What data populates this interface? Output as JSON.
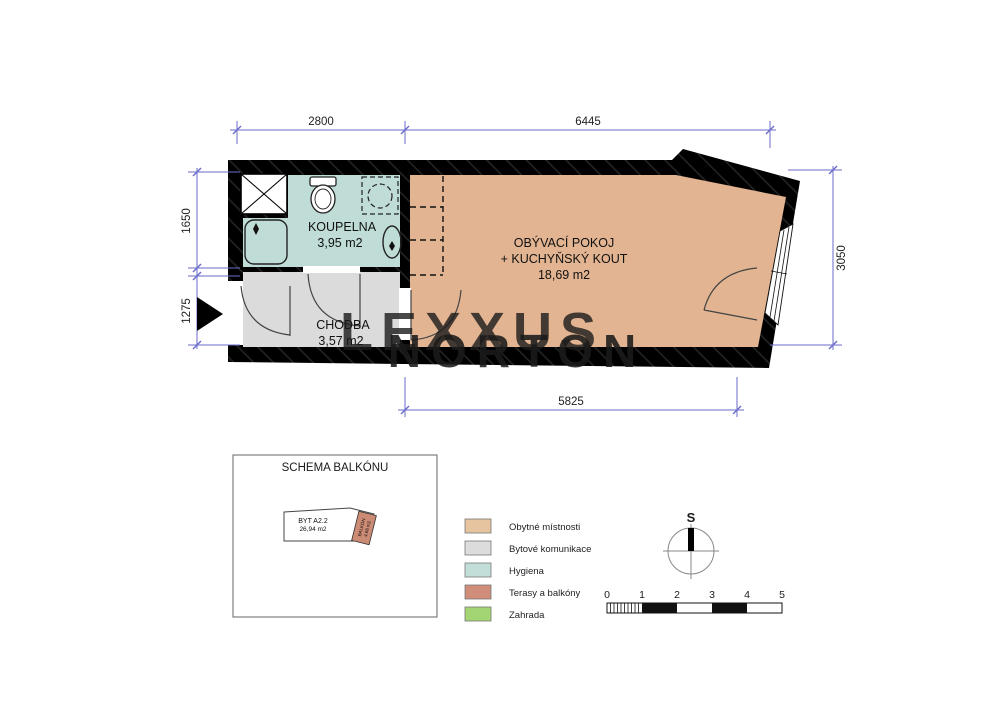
{
  "colors": {
    "wall": "#000000",
    "dimension_line": "#6b6bcb",
    "floor_living": "#e2b491",
    "floor_hall": "#dbdbdb",
    "floor_bath": "#bfdcd7",
    "balcony": "#cc8b74",
    "legend_obytne": "#e6c49f",
    "legend_komunikace": "#dcdcdc",
    "legend_hygiena": "#c2ded9",
    "legend_terasy": "#d08d79",
    "legend_zahrada": "#a3d573"
  },
  "plan": {
    "rooms": {
      "koupelna": {
        "name": "KOUPELNA",
        "area": "3,95 m2"
      },
      "chodba": {
        "name": "CHODBA",
        "area": "3,57 m2"
      },
      "obyvaci": {
        "line1": "OBÝVACÍ POKOJ",
        "line2": "+ KUCHYŇSKÝ KOUT",
        "area": "18,69 m2"
      }
    },
    "dimensions": {
      "top_left": "2800",
      "top_right": "6445",
      "left_upper": "1650",
      "left_lower": "1275",
      "right": "3050",
      "bottom": "5825"
    }
  },
  "watermark": {
    "line1": "LEXXUS",
    "line2": "NORTON"
  },
  "balcony_schema": {
    "title": "SCHEMA BALKÓNU",
    "unit_name": "BYT A2.2",
    "unit_area": "26,94 m2",
    "balcony_name": "BALKÓN",
    "balcony_area": "4,98 m2"
  },
  "legend": {
    "items": [
      {
        "label": "Obytné místnosti",
        "color": "#e6c49f"
      },
      {
        "label": "Bytové komunikace",
        "color": "#dcdcdc"
      },
      {
        "label": "Hygiena",
        "color": "#c2ded9"
      },
      {
        "label": "Terasy a balkóny",
        "color": "#d08d79"
      },
      {
        "label": "Zahrada",
        "color": "#a3d573"
      }
    ]
  },
  "compass": {
    "north_label": "S"
  },
  "scale_bar": {
    "labels": [
      "0",
      "1",
      "2",
      "3",
      "4",
      "5"
    ]
  }
}
